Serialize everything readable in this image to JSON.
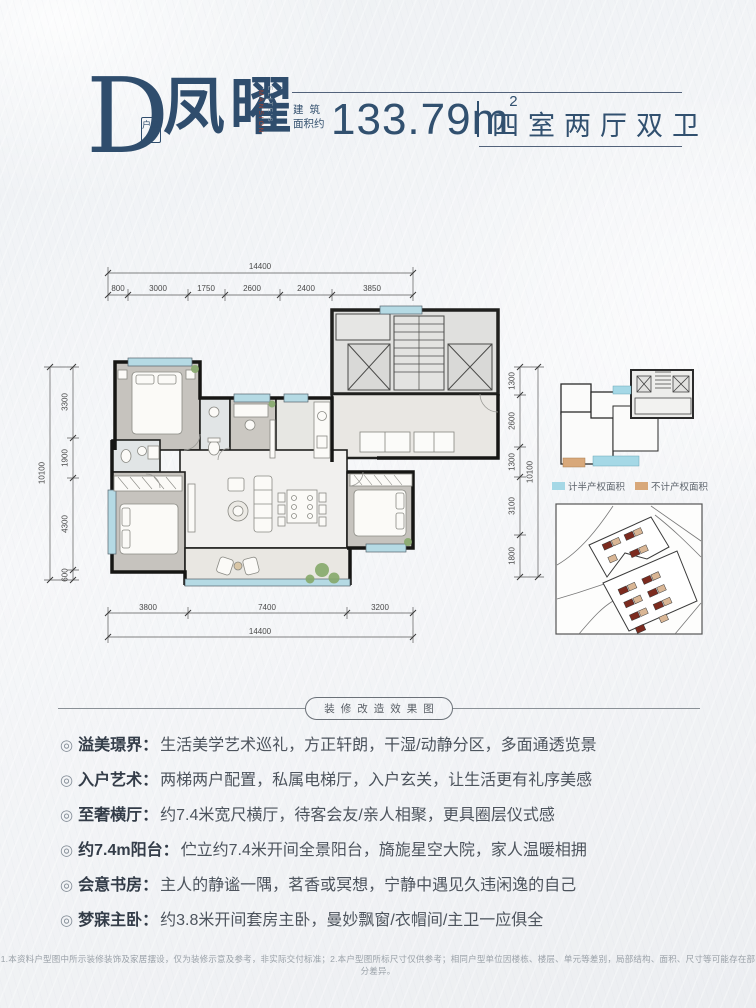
{
  "header": {
    "type_letter": "D",
    "type_tag": "户型",
    "name_cn": "凤曜",
    "name_en_line1": "ELITE'S",
    "name_en_line2": "MANSION",
    "area_prefix_l1": "建筑",
    "area_prefix_l2": "面积约",
    "area_value": "133.79m",
    "area_sup": "2",
    "rooms_text": "四室两厅双卫"
  },
  "colors": {
    "accent_navy": "#2f4d6d",
    "accent_red": "#a23d2b",
    "legend_cyan": "#a5d8e6",
    "legend_tan": "#d8a87a",
    "wall_black": "#1c1c1a"
  },
  "floorplan": {
    "dims": {
      "top": {
        "total": "14400",
        "segments": [
          "800",
          "3000",
          "1750",
          "2600",
          "2400",
          "3850"
        ]
      },
      "bottom": {
        "total": "14400",
        "segments": [
          "3800",
          "7400",
          "3200"
        ]
      },
      "left": {
        "total": "10100",
        "segments": [
          "3300",
          "1900",
          "4300",
          "600"
        ]
      },
      "right": {
        "total": "10100",
        "segments": [
          "1300",
          "2600",
          "1300",
          "3100",
          "1800"
        ]
      }
    }
  },
  "keyplan": {
    "legend": [
      {
        "label": "计半产权面积",
        "color": "#a5d8e6"
      },
      {
        "label": "不计产权面积",
        "color": "#d8a87a"
      }
    ]
  },
  "divider": {
    "label": "装修改造效果图"
  },
  "features_bullet": "◎",
  "features_colon": "：",
  "features": [
    {
      "title": "溢美璟界",
      "desc": "生活美学艺术巡礼，方正轩朗，干湿/动静分区，多面通透览景"
    },
    {
      "title": "入户艺术",
      "desc": "两梯两户配置，私属电梯厅，入户玄关，让生活更有礼序美感"
    },
    {
      "title": "至奢横厅",
      "desc": "约7.4米宽尺横厅，待客会友/亲人相聚，更具圈层仪式感"
    },
    {
      "title": "约7.4m阳台",
      "desc": "伫立约7.4米开间全景阳台，旖旎星空大院，家人温暖相拥"
    },
    {
      "title": "会意书房",
      "desc": "主人的静谧一隅，茗香或冥想，宁静中遇见久违闲逸的自己"
    },
    {
      "title": "梦寐主卧",
      "desc": "约3.8米开间套房主卧，曼妙飘窗/衣帽间/主卫一应俱全"
    }
  ],
  "footnote": "1.本资料户型图中所示装修装饰及家居摆设，仅为装修示意及参考，非实际交付标准；2.本户型图所标尺寸仅供参考；相同户型单位因楼栋、楼层、单元等差别，局部结构、面积、尺寸等可能存在部分差异。"
}
